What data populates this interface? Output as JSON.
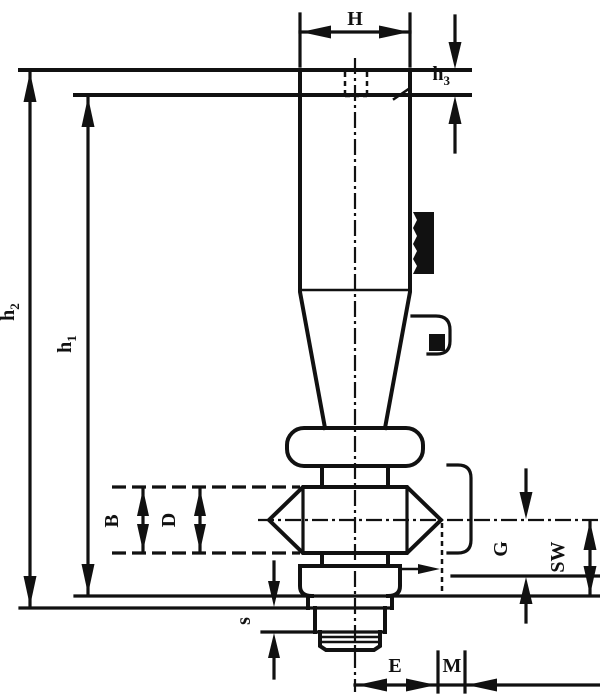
{
  "drawing": {
    "title": "technical-dimension-drawing",
    "background": "#ffffff",
    "line_color": "#111111",
    "labels": {
      "H": "H",
      "h3_base": "h",
      "h3_sub": "3",
      "h2_base": "h",
      "h2_sub": "2",
      "h1_base": "h",
      "h1_sub": "1",
      "B": "B",
      "D": "D",
      "G": "G",
      "SW": "SW",
      "s": "s",
      "E": "E",
      "M": "M"
    }
  }
}
